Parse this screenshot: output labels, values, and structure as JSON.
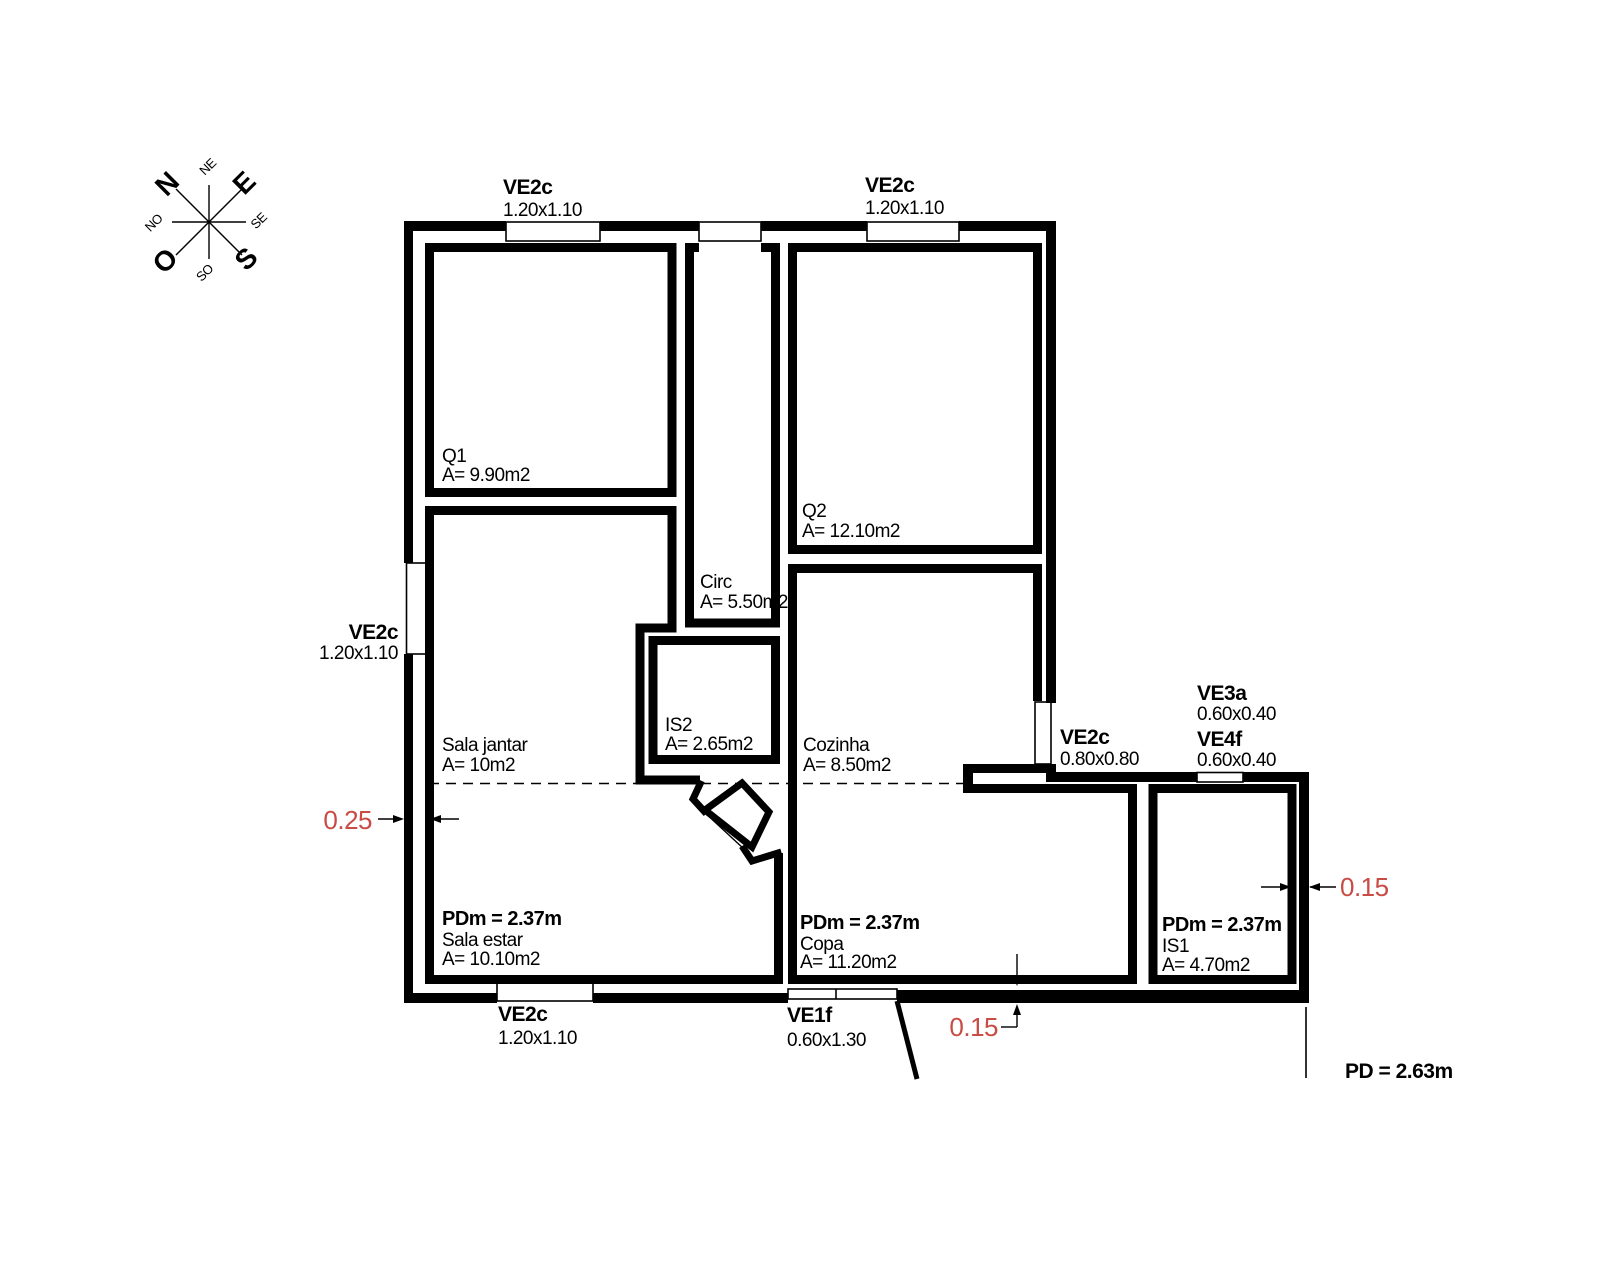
{
  "compass": {
    "n": "N",
    "e": "E",
    "s": "S",
    "o": "O",
    "ne": "NE",
    "se": "SE",
    "so": "SO",
    "no": "NO"
  },
  "rooms": {
    "q1": {
      "name": "Q1",
      "area": "A= 9.90m2"
    },
    "q2": {
      "name": "Q2",
      "area": "A= 12.10m2"
    },
    "circ": {
      "name": "Circ",
      "area": "A= 5.50m2"
    },
    "is2": {
      "name": "IS2",
      "area": "A= 2.65m2"
    },
    "sala_jantar": {
      "name": "Sala jantar",
      "area": "A= 10m2"
    },
    "cozinha": {
      "name": "Cozinha",
      "area": "A= 8.50m2"
    },
    "sala_estar": {
      "ceiling": "PDm = 2.37m",
      "name": "Sala estar",
      "area": "A= 10.10m2"
    },
    "copa": {
      "ceiling": "PDm = 2.37m",
      "name": "Copa",
      "area": "A= 11.20m2"
    },
    "is1": {
      "ceiling": "PDm = 2.37m",
      "name": "IS1",
      "area": "A= 4.70m2"
    }
  },
  "openings": {
    "top_window_1": {
      "code": "VE2c",
      "size": "1.20x1.10"
    },
    "top_window_2": {
      "code": "VE2c",
      "size": "1.20x1.10"
    },
    "left_window": {
      "code": "VE2c",
      "size": "1.20x1.10"
    },
    "right_window": {
      "code": "VE2c",
      "size": "0.80x0.80"
    },
    "ve3a": {
      "code": "VE3a",
      "size": "0.60x0.40"
    },
    "ve4f": {
      "code": "VE4f",
      "size": "0.60x0.40"
    },
    "bottom_window": {
      "code": "VE2c",
      "size": "1.20x1.10"
    },
    "ve1f": {
      "code": "VE1f",
      "size": "0.60x1.30"
    }
  },
  "dimensions": {
    "wall_left": "0.25",
    "wall_right": "0.15",
    "wall_bottom": "0.15"
  },
  "notes": {
    "ceiling_total": "PD = 2.63m"
  },
  "colors": {
    "line": "#000000",
    "dimension_text": "#c84b44",
    "background": "#ffffff"
  }
}
